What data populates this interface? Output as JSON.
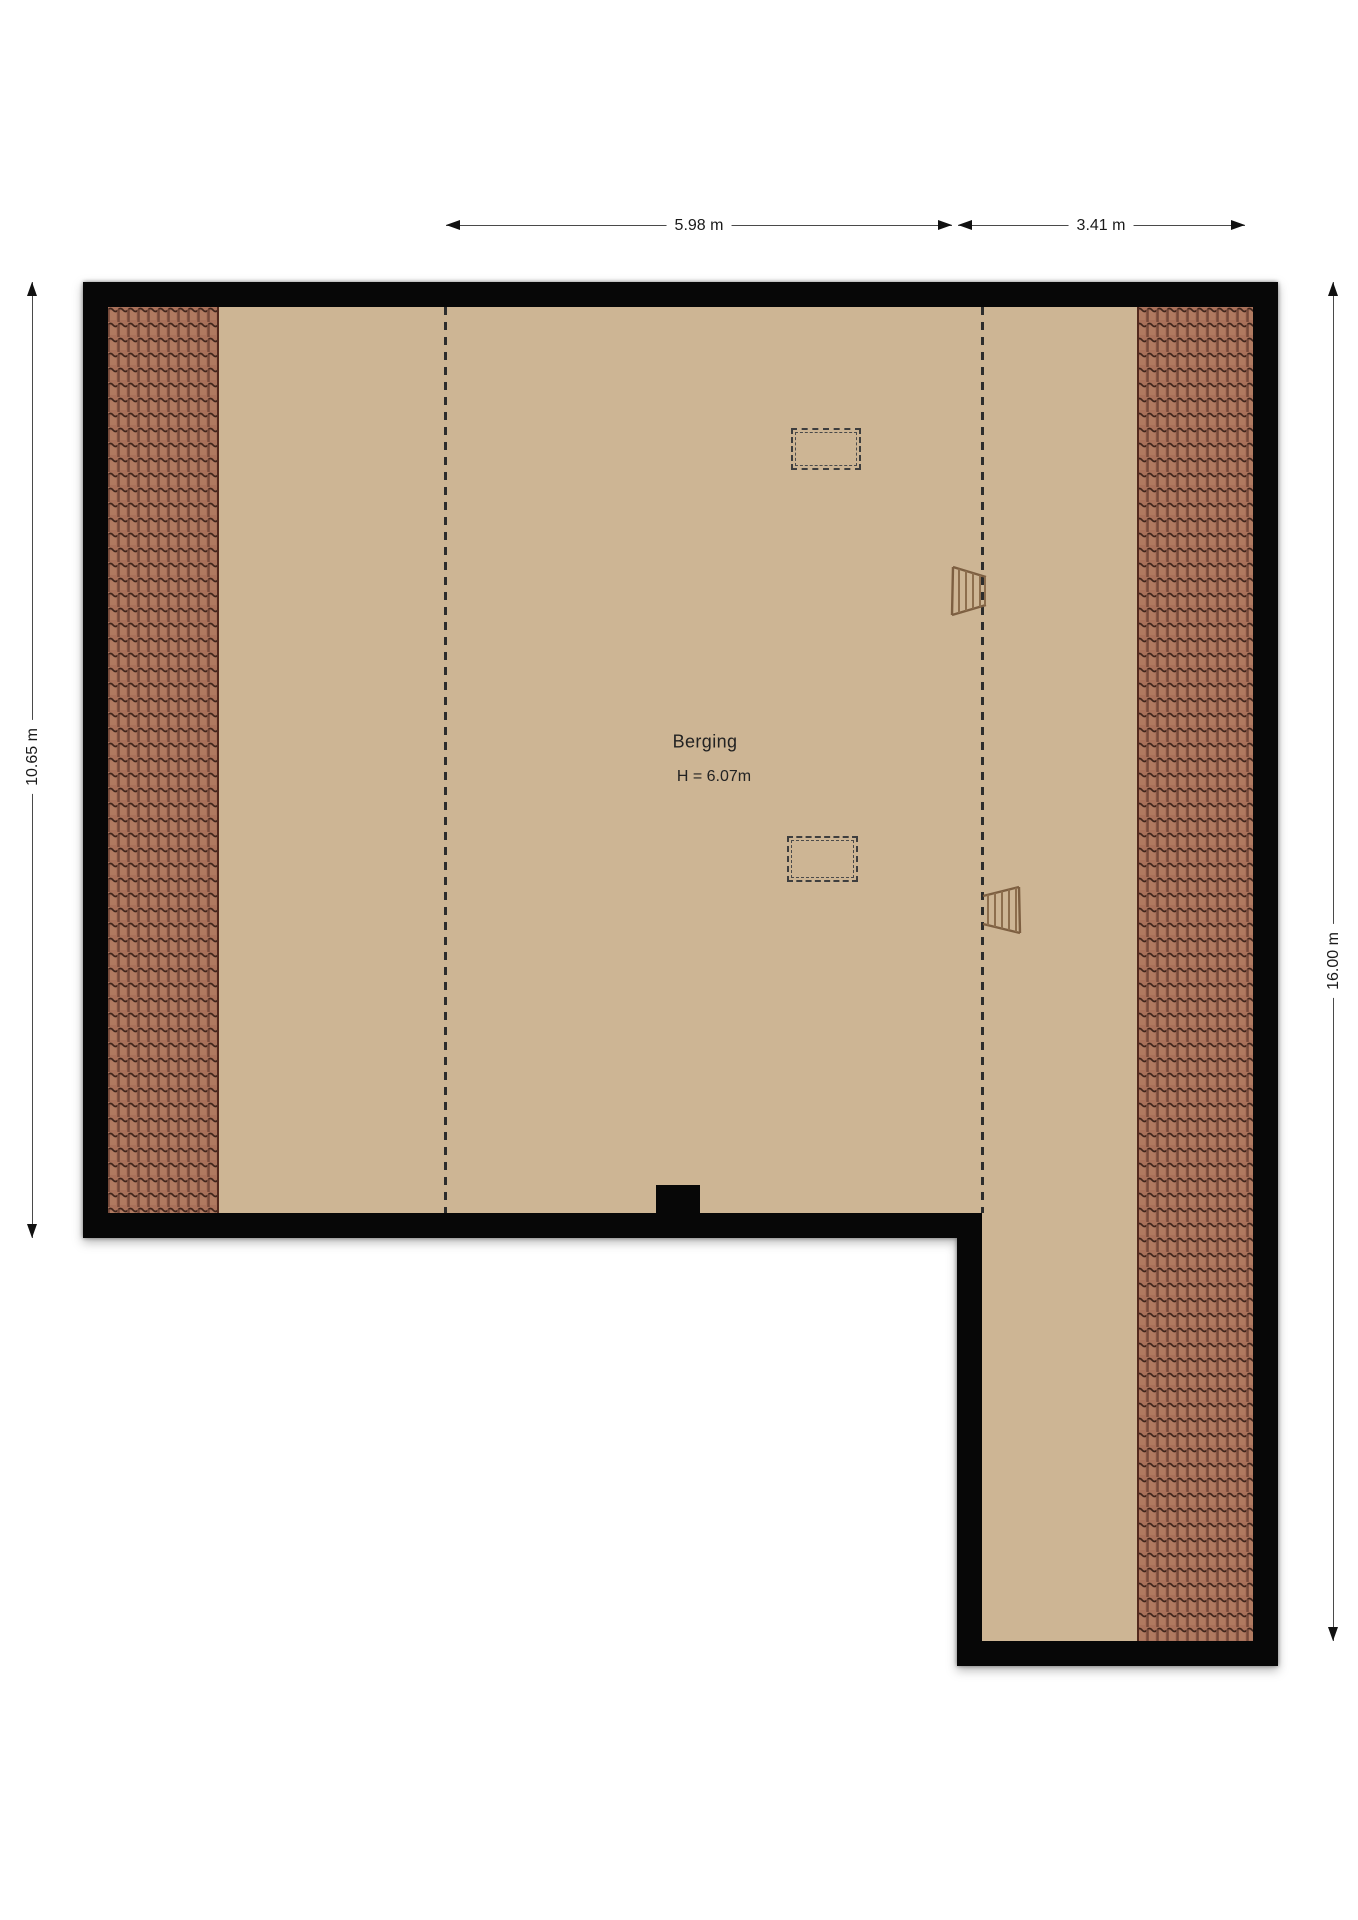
{
  "floor_plan": {
    "room": {
      "label": "Berging",
      "ceiling_height": "H = 6.07m"
    },
    "dimensions": {
      "top_inner_span": "5.98 m",
      "top_outer_span": "3.41 m",
      "left_height": "10.65 m",
      "right_height": "16.00 m"
    },
    "icons": {
      "loft_ladder": "loft-ladder-icon",
      "skylight": "skylight-outline"
    },
    "colors": {
      "floor": "#cdb594",
      "roof_tiles": "#a9715a",
      "roof_tile_groove": "#53291d",
      "walls": "#070707",
      "background": "#ffffff",
      "dimension_line": "#4a4a4a"
    }
  }
}
